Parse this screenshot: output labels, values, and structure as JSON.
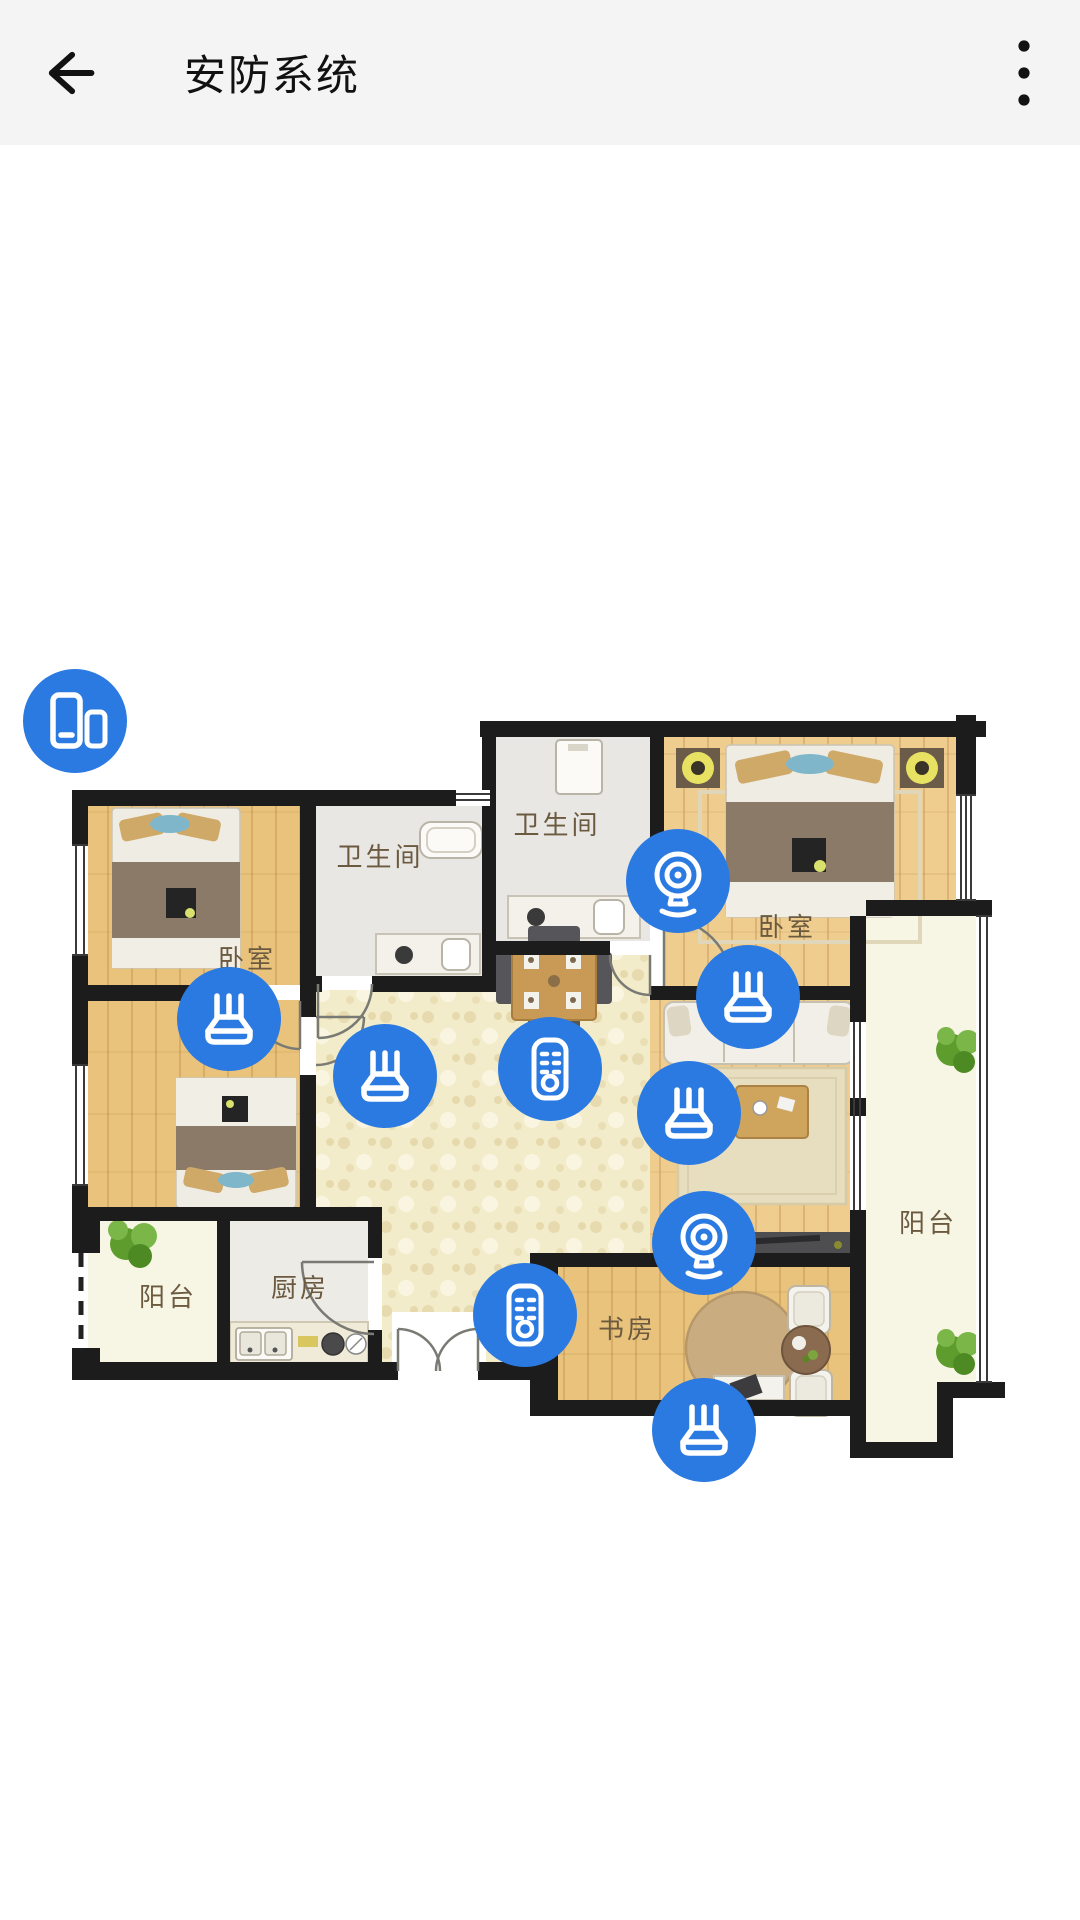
{
  "header": {
    "title": "安防系统",
    "back_icon": "arrow-left-icon",
    "menu_icon": "more-vertical-icon"
  },
  "colors": {
    "accent": "#2b7ae2",
    "header_bg": "#f4f4f4",
    "wall": "#1c1c1c",
    "wood": "#e9c37c",
    "wood_light": "#eecd8f",
    "hall_floor": "#f3ecca",
    "bath_floor": "#e8e7e3",
    "balcony_floor": "#f7f5e4",
    "kitchen_floor": "#edebe6",
    "label_text": "#6b5a40"
  },
  "floor_plan": {
    "rooms": [
      {
        "id": "bedroom-top-left",
        "label": "卧室",
        "x": 247,
        "y": 968
      },
      {
        "id": "bathroom-left",
        "label": "卫生间",
        "x": 380,
        "y": 866
      },
      {
        "id": "bathroom-top",
        "label": "卫生间",
        "x": 557,
        "y": 834
      },
      {
        "id": "bedroom-right",
        "label": "卧室",
        "x": 787,
        "y": 936
      },
      {
        "id": "balcony-right",
        "label": "阳台",
        "x": 928,
        "y": 1232
      },
      {
        "id": "balcony-left",
        "label": "阳台",
        "x": 168,
        "y": 1306
      },
      {
        "id": "kitchen",
        "label": "厨房",
        "x": 300,
        "y": 1297
      },
      {
        "id": "study",
        "label": "书房",
        "x": 627,
        "y": 1338
      }
    ]
  },
  "devices": [
    {
      "id": 1,
      "type": "gateway",
      "icon": "devices-icon",
      "x": 75,
      "y": 721
    },
    {
      "id": 2,
      "type": "camera",
      "icon": "camera-icon",
      "x": 678,
      "y": 881
    },
    {
      "id": 3,
      "type": "sensor",
      "icon": "router-icon",
      "x": 229,
      "y": 1019
    },
    {
      "id": 4,
      "type": "sensor",
      "icon": "router-icon",
      "x": 748,
      "y": 997
    },
    {
      "id": 5,
      "type": "sensor",
      "icon": "router-icon",
      "x": 385,
      "y": 1076
    },
    {
      "id": 6,
      "type": "remote",
      "icon": "remote-icon",
      "x": 550,
      "y": 1069
    },
    {
      "id": 7,
      "type": "sensor",
      "icon": "router-icon",
      "x": 689,
      "y": 1113
    },
    {
      "id": 8,
      "type": "camera",
      "icon": "camera-icon",
      "x": 704,
      "y": 1243
    },
    {
      "id": 9,
      "type": "remote",
      "icon": "remote-icon",
      "x": 525,
      "y": 1315
    },
    {
      "id": 10,
      "type": "sensor",
      "icon": "router-icon",
      "x": 704,
      "y": 1430
    }
  ]
}
